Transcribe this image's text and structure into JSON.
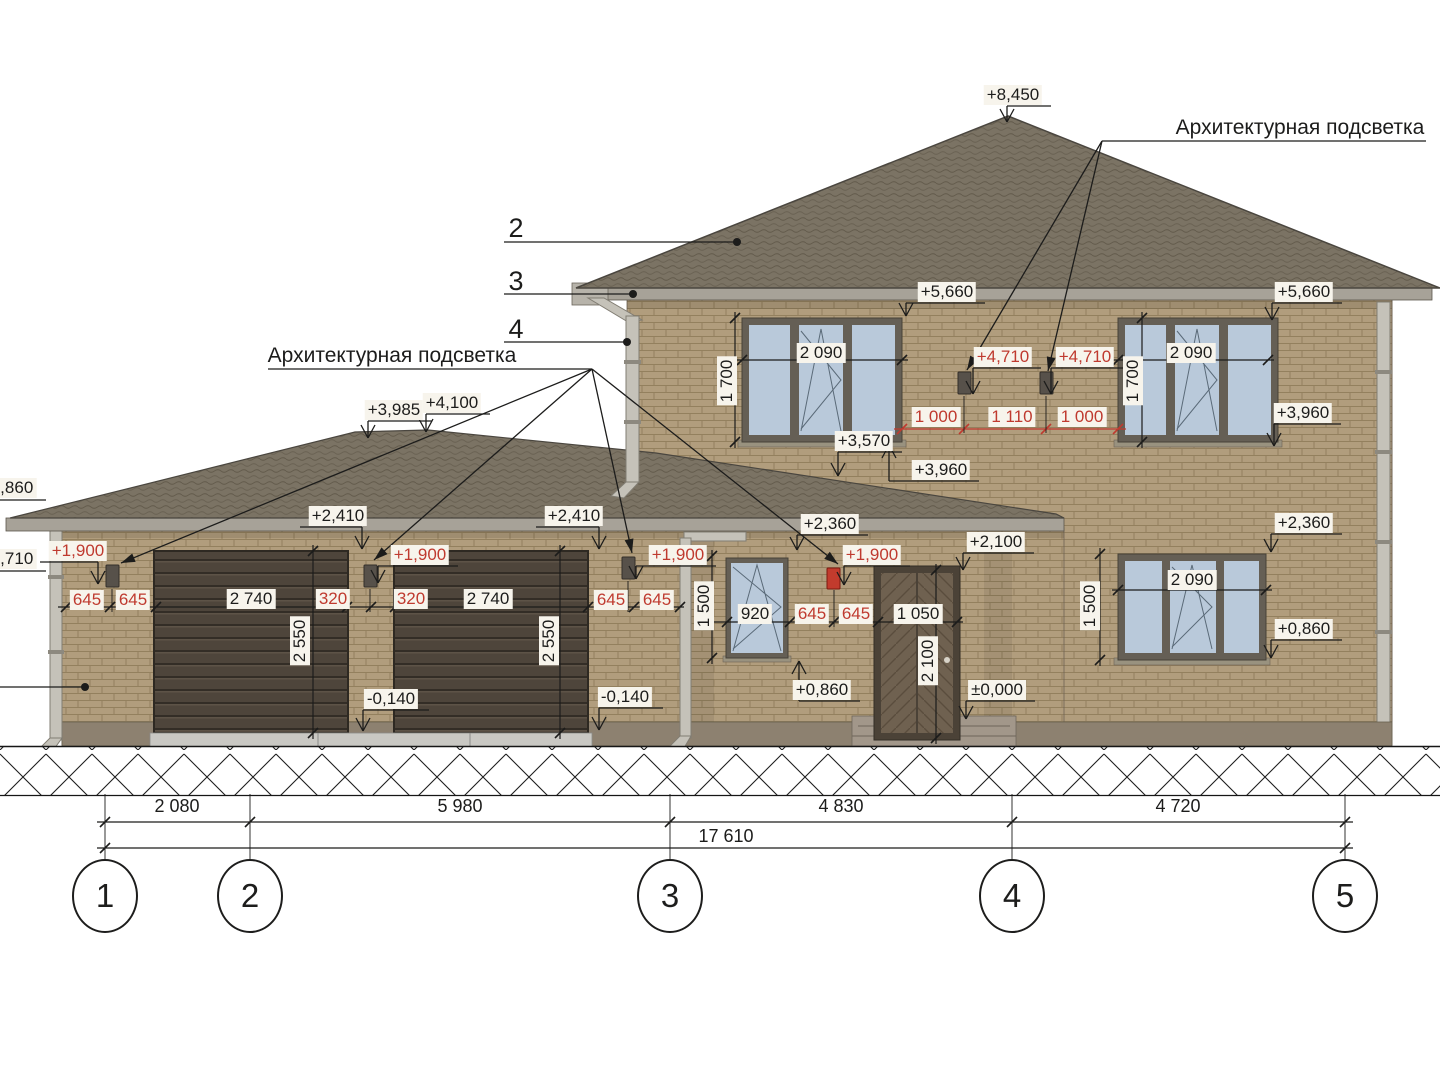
{
  "titles": {
    "left": "Архитектурная подсветка",
    "right": "Архитектурная подсветка"
  },
  "material_callouts": {
    "roof": "2",
    "gutter": "3",
    "downpipe": "4"
  },
  "axes": {
    "bubbles": [
      "1",
      "2",
      "3",
      "4",
      "5"
    ],
    "segment_dims": [
      "2 080",
      "5 980",
      "4 830",
      "4 720"
    ],
    "total_dim": "17 610"
  },
  "colors": {
    "annotation_black": "#1c1c1b",
    "annotation_red": "#bf3a2f",
    "brick": "#b19d7d",
    "roof": "#7b7364",
    "glass": "#b9c9da"
  },
  "elevation_marks": [
    {
      "text": "+8,450",
      "x": 1013,
      "y": 95,
      "tip": [
        1007,
        122
      ],
      "dir": "dn"
    },
    {
      "text": "+5,660",
      "x": 947,
      "y": 292,
      "tip": [
        906,
        316
      ],
      "dir": "dn"
    },
    {
      "text": "+5,660",
      "x": 1304,
      "y": 292,
      "tip": [
        1272,
        320
      ],
      "dir": "dn"
    },
    {
      "text": "+3,960",
      "x": 1303,
      "y": 413,
      "tip": [
        1274,
        446
      ],
      "dir": "dn"
    },
    {
      "text": "+3,960",
      "x": 941,
      "y": 470,
      "tip": [
        889,
        445
      ],
      "dir": "up"
    },
    {
      "text": "+3,570",
      "x": 864,
      "y": 441,
      "tip": [
        838,
        476
      ],
      "dir": "dn"
    },
    {
      "text": "+3,985",
      "x": 394,
      "y": 410,
      "tip": [
        368,
        438
      ],
      "dir": "dn"
    },
    {
      "text": "+4,100",
      "x": 452,
      "y": 403,
      "tip": [
        426,
        432
      ],
      "dir": "dn"
    },
    {
      "text": "+2,410",
      "x": 338,
      "y": 516,
      "tip": [
        362,
        549
      ],
      "dir": "dn"
    },
    {
      "text": "+2,410",
      "x": 574,
      "y": 516,
      "tip": [
        599,
        549
      ],
      "dir": "dn"
    },
    {
      "text": "+2,360",
      "x": 830,
      "y": 524,
      "tip": [
        797,
        550
      ],
      "dir": "dn"
    },
    {
      "text": "+2,360",
      "x": 1304,
      "y": 523,
      "tip": [
        1271,
        552
      ],
      "dir": "dn"
    },
    {
      "text": "+2,100",
      "x": 996,
      "y": 542,
      "tip": [
        963,
        570
      ],
      "dir": "dn"
    },
    {
      "text": "+0,860",
      "x": 822,
      "y": 690,
      "tip": [
        799,
        661
      ],
      "dir": "up"
    },
    {
      "text": "+0,860",
      "x": 1304,
      "y": 629,
      "tip": [
        1271,
        658
      ],
      "dir": "dn"
    },
    {
      "text": "±0,000",
      "x": 997,
      "y": 690,
      "tip": [
        966,
        719
      ],
      "dir": "dn"
    },
    {
      "text": "-0,140",
      "x": 391,
      "y": 699,
      "tip": [
        363,
        731
      ],
      "dir": "dn"
    },
    {
      "text": "-0,140",
      "x": 625,
      "y": 697,
      "tip": [
        599,
        730
      ],
      "dir": "dn"
    },
    {
      "text": "2,860",
      "x": 12,
      "y": 488
    },
    {
      "text": "2,710",
      "x": 12,
      "y": 559
    },
    {
      "text": "+4,710",
      "x": 1003,
      "y": 357,
      "tip": [
        973,
        394
      ],
      "dir": "dn",
      "color": "red"
    },
    {
      "text": "+4,710",
      "x": 1085,
      "y": 357,
      "tip": [
        1051,
        394
      ],
      "dir": "dn",
      "color": "red"
    },
    {
      "text": "+1,900",
      "x": 78,
      "y": 551,
      "tip": [
        98,
        584
      ],
      "dir": "dn",
      "color": "red"
    },
    {
      "text": "+1,900",
      "x": 420,
      "y": 555,
      "tip": [
        378,
        583
      ],
      "dir": "dn",
      "color": "red"
    },
    {
      "text": "+1,900",
      "x": 678,
      "y": 555,
      "tip": [
        636,
        579
      ],
      "dir": "dn",
      "color": "red"
    },
    {
      "text": "+1,900",
      "x": 872,
      "y": 555,
      "tip": [
        844,
        585
      ],
      "dir": "dn",
      "color": "red"
    }
  ],
  "dimension_labels": [
    {
      "text": "2 090",
      "x": 821,
      "y": 353
    },
    {
      "text": "2 090",
      "x": 1191,
      "y": 353
    },
    {
      "text": "2 090",
      "x": 1192,
      "y": 580
    },
    {
      "text": "1 700",
      "x": 727,
      "y": 381,
      "rot": true
    },
    {
      "text": "1 700",
      "x": 1133,
      "y": 381,
      "rot": true
    },
    {
      "text": "1 500",
      "x": 704,
      "y": 606,
      "rot": true
    },
    {
      "text": "1 500",
      "x": 1090,
      "y": 606,
      "rot": true
    },
    {
      "text": "2 550",
      "x": 300,
      "y": 641,
      "rot": true
    },
    {
      "text": "2 550",
      "x": 549,
      "y": 641,
      "rot": true
    },
    {
      "text": "2 100",
      "x": 928,
      "y": 661,
      "rot": true
    },
    {
      "text": "2 740",
      "x": 251,
      "y": 599
    },
    {
      "text": "2 740",
      "x": 488,
      "y": 599
    },
    {
      "text": "1 050",
      "x": 918,
      "y": 614
    },
    {
      "text": "920",
      "x": 755,
      "y": 614
    },
    {
      "text": "645",
      "x": 87,
      "y": 600,
      "color": "red"
    },
    {
      "text": "645",
      "x": 133,
      "y": 600,
      "color": "red"
    },
    {
      "text": "320",
      "x": 333,
      "y": 599,
      "color": "red"
    },
    {
      "text": "320",
      "x": 411,
      "y": 599,
      "color": "red"
    },
    {
      "text": "645",
      "x": 611,
      "y": 600,
      "color": "red"
    },
    {
      "text": "645",
      "x": 657,
      "y": 600,
      "color": "red"
    },
    {
      "text": "645",
      "x": 812,
      "y": 614,
      "color": "red"
    },
    {
      "text": "645",
      "x": 856,
      "y": 614,
      "color": "red"
    },
    {
      "text": "1 000",
      "x": 936,
      "y": 417,
      "color": "red"
    },
    {
      "text": "1 110",
      "x": 1012,
      "y": 417,
      "color": "red"
    },
    {
      "text": "1 000",
      "x": 1082,
      "y": 417,
      "color": "red"
    }
  ],
  "bottom_dims": [
    {
      "text": "2 080",
      "x": 177,
      "y": 806
    },
    {
      "text": "5 980",
      "x": 460,
      "y": 806
    },
    {
      "text": "4 830",
      "x": 841,
      "y": 806
    },
    {
      "text": "4 720",
      "x": 1178,
      "y": 806
    },
    {
      "text": "17 610",
      "x": 726,
      "y": 836
    }
  ],
  "dimlines": [
    {
      "x1": 58,
      "y1": 607,
      "x2": 684,
      "y2": 607,
      "ticks": [
        66,
        110,
        156,
        347,
        371,
        395,
        588,
        634,
        680
      ]
    },
    {
      "x1": 736,
      "y1": 360,
      "x2": 908,
      "y2": 360,
      "ticks": [
        742,
        902
      ]
    },
    {
      "x1": 1112,
      "y1": 360,
      "x2": 1274,
      "y2": 360,
      "ticks": [
        1118,
        1268
      ]
    },
    {
      "x1": 1112,
      "y1": 590,
      "x2": 1272,
      "y2": 590,
      "ticks": [
        1118,
        1266
      ]
    },
    {
      "x1": 894,
      "y1": 429,
      "x2": 1126,
      "y2": 429,
      "ticks": [
        902,
        964,
        1046,
        1118
      ],
      "color": "red"
    },
    {
      "x1": 714,
      "y1": 622,
      "x2": 963,
      "y2": 622,
      "ticks": [
        727,
        790,
        834,
        878,
        957
      ]
    },
    {
      "x1": 735,
      "y1": 312,
      "x2": 735,
      "y2": 448,
      "ticks": [
        318,
        442
      ]
    },
    {
      "x1": 1142,
      "y1": 312,
      "x2": 1142,
      "y2": 448,
      "ticks": [
        318,
        442
      ]
    },
    {
      "x1": 712,
      "y1": 550,
      "x2": 712,
      "y2": 664,
      "ticks": [
        556,
        658
      ]
    },
    {
      "x1": 1100,
      "y1": 548,
      "x2": 1100,
      "y2": 666,
      "ticks": [
        554,
        660
      ]
    },
    {
      "x1": 313,
      "y1": 545,
      "x2": 313,
      "y2": 739,
      "ticks": [
        551,
        733
      ]
    },
    {
      "x1": 560,
      "y1": 545,
      "x2": 560,
      "y2": 739,
      "ticks": [
        551,
        733
      ]
    },
    {
      "x1": 936,
      "y1": 564,
      "x2": 936,
      "y2": 744,
      "ticks": [
        570,
        738
      ]
    },
    {
      "x1": 97,
      "y1": 822,
      "x2": 1353,
      "y2": 822,
      "ticks": [
        105,
        250,
        670,
        1012,
        1345
      ]
    },
    {
      "x1": 97,
      "y1": 848,
      "x2": 1353,
      "y2": 848,
      "ticks": [
        105,
        1345
      ]
    }
  ],
  "leaders": [
    {
      "pts": [
        [
          504,
          242
        ],
        [
          737,
          242
        ]
      ],
      "end": "dot"
    },
    {
      "pts": [
        [
          504,
          294
        ],
        [
          633,
          294
        ]
      ],
      "end": "dot"
    },
    {
      "pts": [
        [
          504,
          342
        ],
        [
          627,
          342
        ]
      ],
      "end": "dot"
    },
    {
      "pts": [
        [
          0,
          687
        ],
        [
          85,
          687
        ]
      ],
      "end": "dot"
    },
    {
      "pts": [
        [
          268,
          369
        ],
        [
          592,
          369
        ]
      ]
    },
    {
      "pts": [
        [
          592,
          369
        ],
        [
          121,
          563
        ]
      ],
      "end": "arrow"
    },
    {
      "pts": [
        [
          592,
          369
        ],
        [
          374,
          560
        ]
      ],
      "end": "arrow"
    },
    {
      "pts": [
        [
          592,
          369
        ],
        [
          632,
          553
        ]
      ],
      "end": "arrow"
    },
    {
      "pts": [
        [
          592,
          369
        ],
        [
          838,
          564
        ]
      ],
      "end": "arrow"
    },
    {
      "pts": [
        [
          1102,
          141
        ],
        [
          1426,
          141
        ]
      ]
    },
    {
      "pts": [
        [
          1102,
          141
        ],
        [
          967,
          370
        ]
      ],
      "end": "arrow"
    },
    {
      "pts": [
        [
          1102,
          141
        ],
        [
          1048,
          371
        ]
      ],
      "end": "arrow"
    },
    {
      "pts": [
        [
          0,
          500
        ],
        [
          46,
          500
        ]
      ]
    },
    {
      "pts": [
        [
          0,
          571
        ],
        [
          46,
          571
        ]
      ]
    },
    {
      "pts": [
        [
          105,
          794
        ],
        [
          105,
          863
        ]
      ],
      "w": 0.9
    },
    {
      "pts": [
        [
          250,
          794
        ],
        [
          250,
          863
        ]
      ],
      "w": 0.9
    },
    {
      "pts": [
        [
          670,
          794
        ],
        [
          670,
          863
        ]
      ],
      "w": 0.9
    },
    {
      "pts": [
        [
          1012,
          794
        ],
        [
          1012,
          863
        ]
      ],
      "w": 0.9
    },
    {
      "pts": [
        [
          1345,
          794
        ],
        [
          1345,
          863
        ]
      ],
      "w": 0.9
    },
    {
      "pts": [
        [
          964,
          396
        ],
        [
          964,
          433
        ]
      ],
      "w": 0.9
    },
    {
      "pts": [
        [
          1046,
          396
        ],
        [
          1046,
          433
        ]
      ],
      "w": 0.9
    },
    {
      "pts": [
        [
          112,
          589
        ],
        [
          112,
          612
        ]
      ],
      "w": 0.9
    },
    {
      "pts": [
        [
          370,
          589
        ],
        [
          370,
          612
        ]
      ],
      "w": 0.9
    },
    {
      "pts": [
        [
          628,
          581
        ],
        [
          628,
          612
        ]
      ],
      "w": 0.9
    },
    {
      "pts": [
        [
          834,
          590
        ],
        [
          834,
          627
        ]
      ],
      "w": 0.9
    }
  ],
  "axis_bubble_positions": [
    {
      "x": 105,
      "y": 896
    },
    {
      "x": 250,
      "y": 896
    },
    {
      "x": 670,
      "y": 896
    },
    {
      "x": 1012,
      "y": 896
    },
    {
      "x": 1345,
      "y": 896
    }
  ]
}
